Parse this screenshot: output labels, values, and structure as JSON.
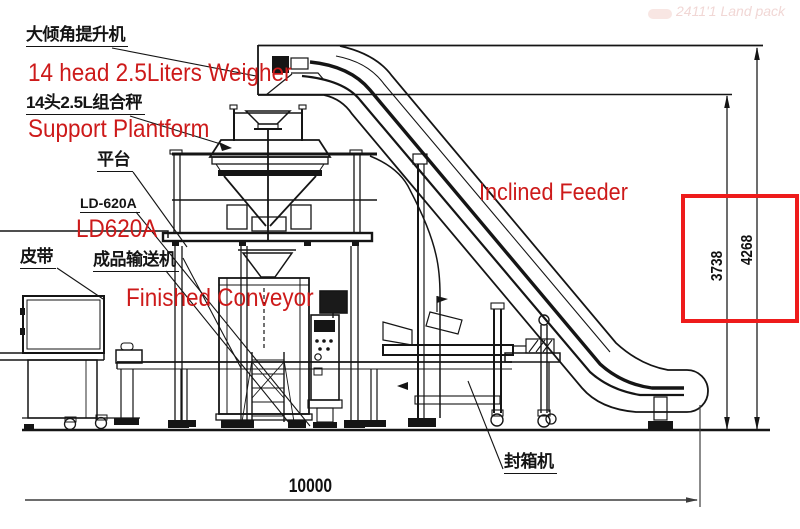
{
  "colors": {
    "annotation_red": "#cd1a1a",
    "highlight_box_red": "#ee1b1b",
    "line_black": "#151515"
  },
  "labels": {
    "cn_elevator": "大倾角提升机",
    "en_weigher": "14 head 2.5Liters Weigher",
    "cn_weigher": "14头2.5L组合秤",
    "en_platform": "Support Plantform",
    "cn_platform": "平台",
    "cn_model": "LD-620A",
    "en_model": "LD620A",
    "cn_belt": "皮带",
    "cn_finished_conveyor": "成品输送机",
    "en_finished_conveyor": "Finished Conveyor",
    "en_inclined_feeder": "Inclined Feeder",
    "cn_carton_sealer": "封箱机"
  },
  "dimensions": {
    "total_length": "10000",
    "infeed_height": "3738",
    "overall_height": "4268"
  },
  "watermark": "2411'1 Land pack"
}
